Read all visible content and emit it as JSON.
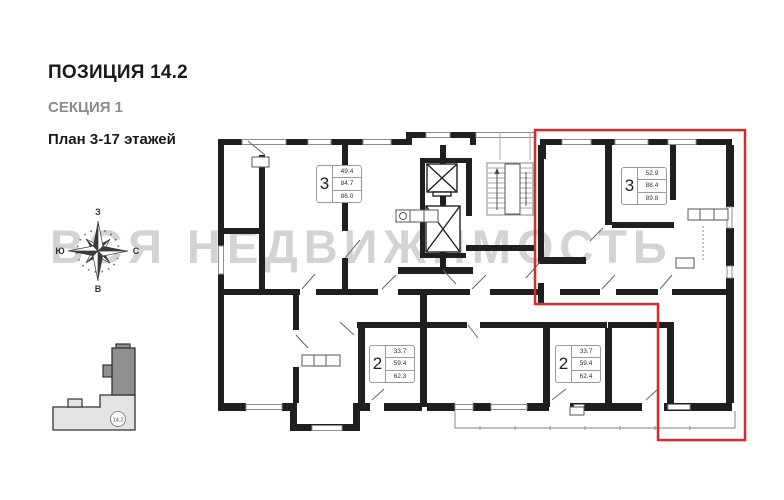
{
  "header": {
    "position_title": "ПОЗИЦИЯ 14.2",
    "section": "СЕКЦИЯ 1",
    "floors": "План 3-17 этажей"
  },
  "compass": {
    "west": "З",
    "north": "С",
    "east": "В",
    "south": "Ю"
  },
  "watermark": "ВСЯ НЕДВИЖИМОСТЬ",
  "minimap": {
    "position_label": "14.2"
  },
  "apartments": [
    {
      "rooms": "3",
      "living_area": "49.4",
      "area": "84.7",
      "total_area": "86.0"
    },
    {
      "rooms": "3",
      "living_area": "52.9",
      "area": "88.4",
      "total_area": "89.8"
    },
    {
      "rooms": "2",
      "living_area": "33.7",
      "area": "59.4",
      "total_area": "62.3"
    },
    {
      "rooms": "2",
      "living_area": "33.7",
      "area": "59.4",
      "total_area": "62.4"
    }
  ],
  "highlight_color": "#d92b2b"
}
